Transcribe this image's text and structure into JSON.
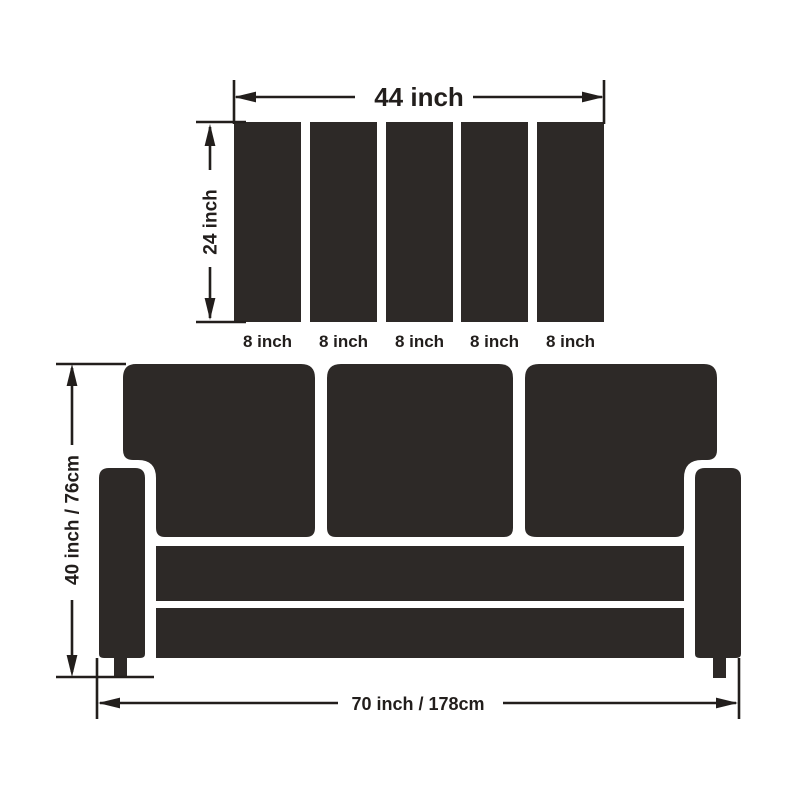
{
  "title": "Sofa and cushion panel dimensions diagram",
  "colors": {
    "dark": "#2d2927",
    "line": "#221e1c",
    "text": "#221e1c",
    "background": "#ffffff"
  },
  "panel_diagram": {
    "panel_count": 5,
    "width_label": "44 inch",
    "height_label": "24 inch",
    "panel_labels": [
      "8 inch",
      "8 inch",
      "8 inch",
      "8 inch",
      "8 inch"
    ]
  },
  "sofa_diagram": {
    "cushion_count": 3,
    "height_label": "40 inch / 76cm",
    "width_label": "70 inch / 178cm"
  }
}
